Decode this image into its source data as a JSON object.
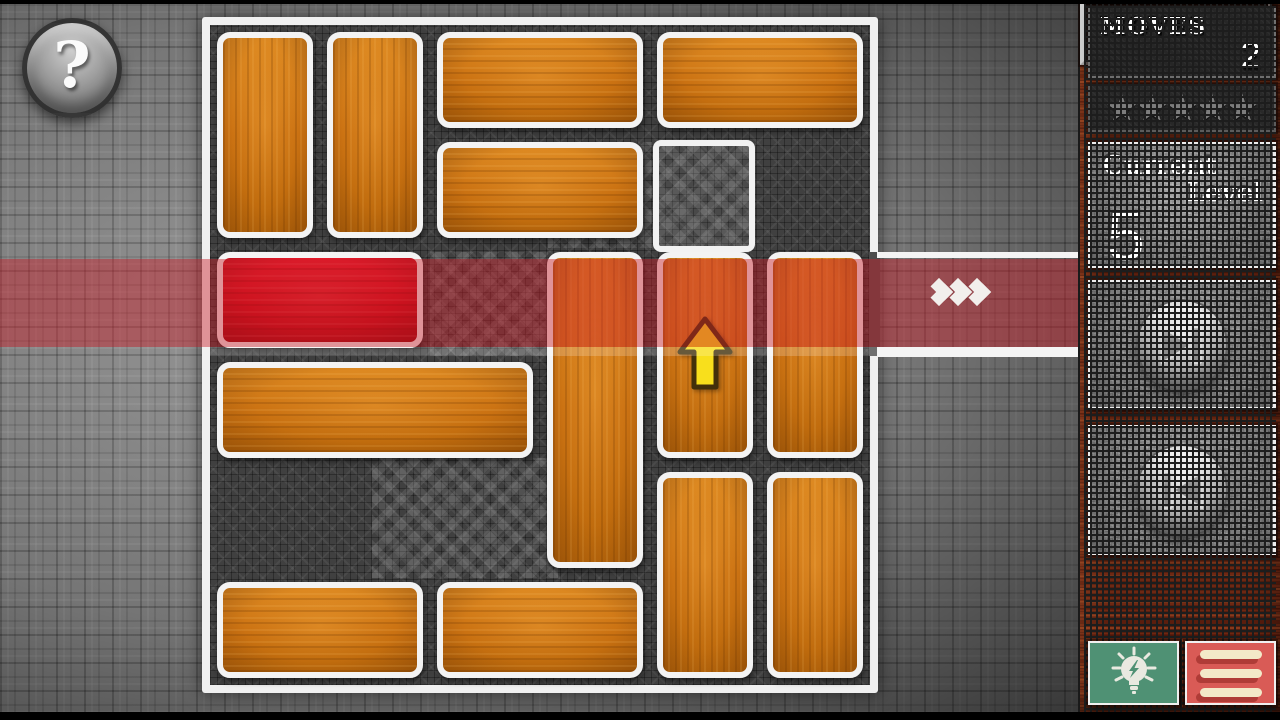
{
  "help_button": {
    "label": "?",
    "icon": "question-mark-icon"
  },
  "sidebar": {
    "moves_panel": {
      "label": "MOVES",
      "value": "2"
    },
    "stars_panel": {
      "count": 5,
      "glyph": "★"
    },
    "level_panel": {
      "label_line1": "Current",
      "label_line2": "Level",
      "value": "5"
    },
    "next_button": {
      "icon": "skip-next-icon"
    },
    "prev_button": {
      "icon": "skip-previous-icon"
    },
    "timer_panel": {
      "value": "3 : 50"
    },
    "hint_button": {
      "icon": "lightbulb-icon"
    },
    "menu_button": {
      "icon": "hamburger-menu-icon",
      "bar_count": 3
    }
  },
  "board": {
    "grid": {
      "cols": 6,
      "rows": 6
    },
    "exit": {
      "side": "right",
      "row": 3,
      "chevron_count": 3,
      "chevron_icon": "chevron-right-icon"
    },
    "hint_outline": {
      "col": 5,
      "row": 2,
      "w": 1,
      "h": 1
    },
    "blocks": [
      {
        "id": "b1",
        "col": 1,
        "row": 1,
        "w": 1,
        "h": 2,
        "color": "orange"
      },
      {
        "id": "b2",
        "col": 2,
        "row": 1,
        "w": 1,
        "h": 2,
        "color": "orange"
      },
      {
        "id": "b3",
        "col": 3,
        "row": 1,
        "w": 2,
        "h": 1,
        "color": "orange"
      },
      {
        "id": "b4",
        "col": 5,
        "row": 1,
        "w": 2,
        "h": 1,
        "color": "orange"
      },
      {
        "id": "b5",
        "col": 3,
        "row": 2,
        "w": 2,
        "h": 1,
        "color": "orange"
      },
      {
        "id": "target",
        "col": 1,
        "row": 3,
        "w": 2,
        "h": 1,
        "color": "red"
      },
      {
        "id": "b7",
        "col": 4,
        "row": 3,
        "w": 1,
        "h": 3,
        "color": "orange"
      },
      {
        "id": "b8",
        "col": 5,
        "row": 3,
        "w": 1,
        "h": 2,
        "color": "orange",
        "hint_arrow": "up"
      },
      {
        "id": "b9",
        "col": 6,
        "row": 3,
        "w": 1,
        "h": 2,
        "color": "orange"
      },
      {
        "id": "b10",
        "col": 1,
        "row": 4,
        "w": 3,
        "h": 1,
        "color": "orange"
      },
      {
        "id": "b11",
        "col": 5,
        "row": 5,
        "w": 1,
        "h": 2,
        "color": "orange"
      },
      {
        "id": "b12",
        "col": 6,
        "row": 5,
        "w": 1,
        "h": 2,
        "color": "orange"
      },
      {
        "id": "b13",
        "col": 1,
        "row": 6,
        "w": 2,
        "h": 1,
        "color": "orange"
      },
      {
        "id": "b14",
        "col": 3,
        "row": 6,
        "w": 2,
        "h": 1,
        "color": "orange"
      }
    ]
  },
  "colors": {
    "block_orange": "#cf7413",
    "block_red": "#d60e1c",
    "exit_highlight": "rgba(202,30,42,0.45)",
    "board_background": "#404040",
    "wood_frame": "#6e2813",
    "hint_green": "#4f9174",
    "menu_red": "#d95b56",
    "star_gray": "#7d7d7d",
    "arrow_yellow": "#f8df1c"
  }
}
